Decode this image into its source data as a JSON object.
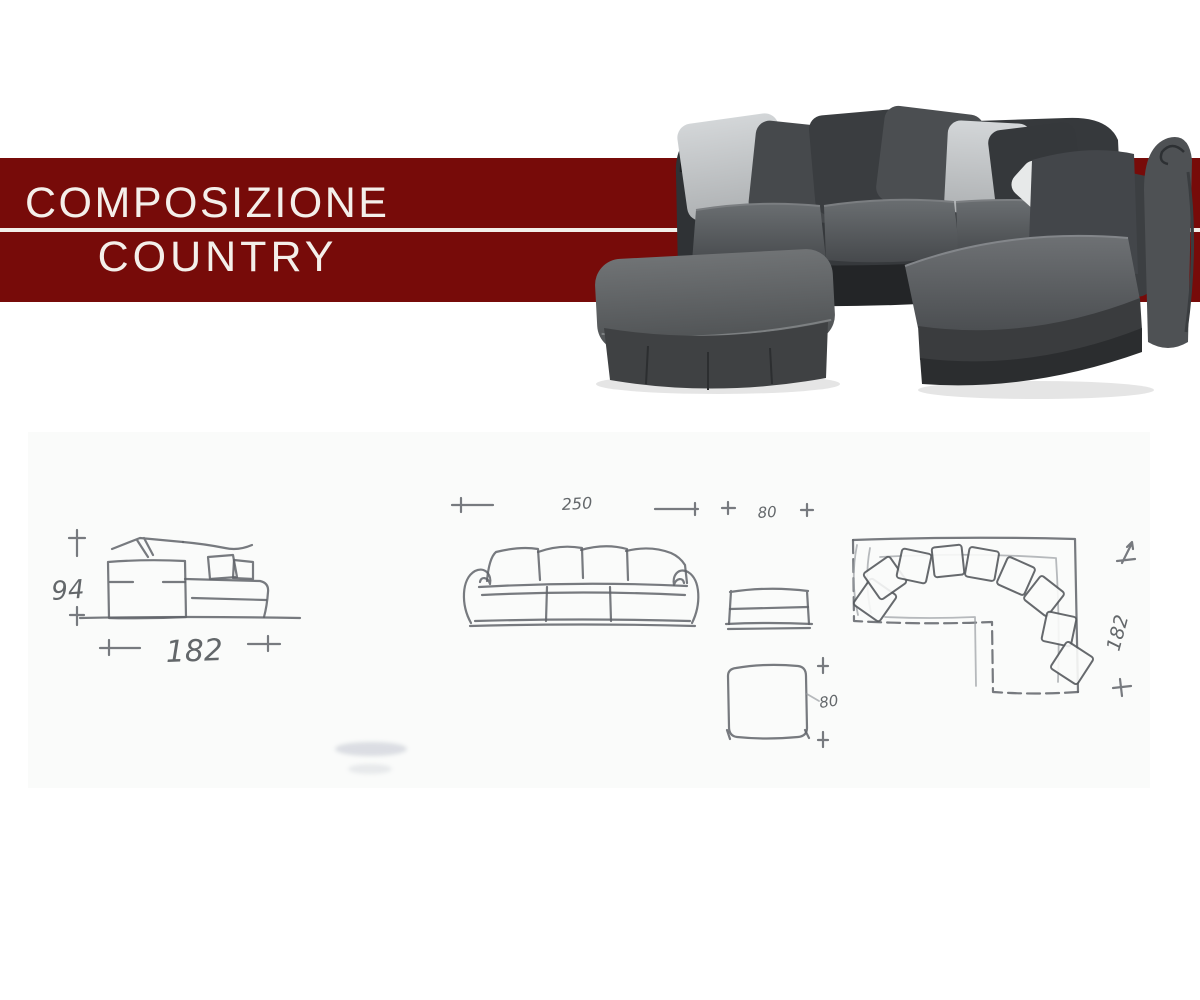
{
  "banner": {
    "line1": "COMPOSIZIONE",
    "line2": "COUNTRY",
    "background_color": "#770B09",
    "separator_color": "#F2EFE9",
    "text_color": "#F4EFEA"
  },
  "photo": {
    "description": "dark grey fabric corner sofa with scatter cushions and large ottoman footstool",
    "fabric_dark": "#36393C",
    "fabric_mid": "#55585B",
    "cushion_light": "#C5C8CA"
  },
  "dimensions": {
    "side_view": {
      "height": "94",
      "width": "182"
    },
    "front_view": {
      "sofa_width": "250",
      "pouf_width": "80"
    },
    "pouf_top_view": {
      "depth": "80"
    },
    "plan_view": {
      "depth": "182"
    }
  }
}
